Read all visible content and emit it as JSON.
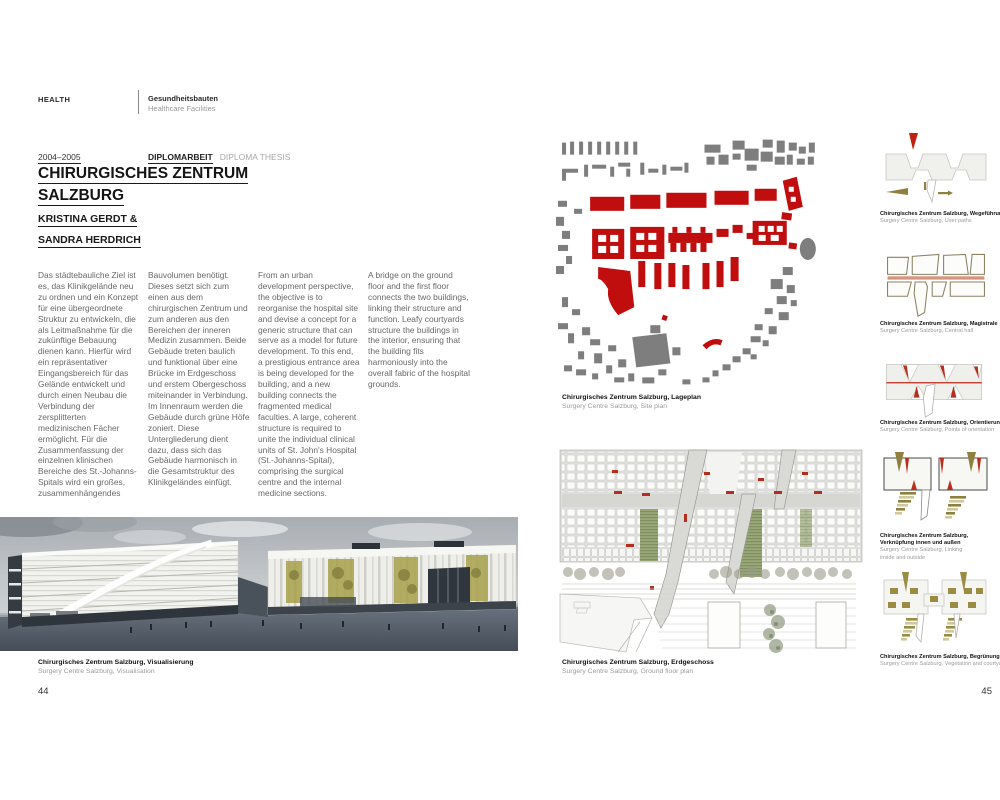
{
  "book": {
    "left_page": {
      "header": {
        "section_label": "HEALTH",
        "category_de": "Gesundheitsbauten",
        "category_en": "Healthcare Facilities"
      },
      "meta": {
        "years": "2004–2005",
        "type_de": "DIPLOMARBEIT",
        "type_en": "DIPLOMA THESIS"
      },
      "title": {
        "line1": "CHIRURGISCHES ZENTRUM",
        "line2": "SALZBURG"
      },
      "authors": {
        "line1": "KRISTINA GERDT &",
        "line2": "SANDRA HERDRICH"
      },
      "body_columns": [
        {
          "lang": "de",
          "text": "Das städtebauliche Ziel ist es, das Klinikgelände neu zu ordnen und ein Konzept für eine übergeordnete Struktur zu entwickeln, die als Leitmaßnahme für die zukünftige Bebauung dienen kann. Hierfür wird ein repräsentativer Eingangsbereich für das Gelände entwickelt und durch einen Neubau die Verbindung der zersplitterten medizinischen Fächer ermöglicht. Für die Zusammenfassung der einzelnen klinischen Bereiche des St.-Johanns-Spitals wird ein großes, zusammenhängendes"
        },
        {
          "lang": "de",
          "text": "Bauvolumen benötigt. Dieses setzt sich zum einen aus dem chirurgischen Zentrum und zum anderen aus den Bereichen der inneren Medizin zusammen. Beide Gebäude treten baulich und funktional über eine Brücke im Erdgeschoss und erstem Obergeschoss miteinander in Verbindung. Im Innenraum werden die Gebäude durch grüne Höfe zoniert. Diese Untergliederung dient dazu, dass sich das Gebäude harmonisch in die Gesamtstruktur des Klinikgeländes einfügt."
        },
        {
          "lang": "en",
          "text": "From an urban development perspective, the objective is to reorganise the hospital site and devise a concept for a generic structure that can serve as a model for future development. To this end, a prestigious entrance area is being developed for the building, and a new building connects the fragmented medical faculties. A large, coherent structure is required to unite the individual clinical units of St. John's Hospital (St.-Johanns-Spital), comprising the surgical centre and the internal medicine sections."
        },
        {
          "lang": "en",
          "text": "A bridge on the ground floor and the first floor connects the two buildings, linking their structure and function. Leafy courtyards structure the buildings in the interior, ensuring that the building fits harmoniously into the overall fabric of the hospital grounds."
        }
      ],
      "visual_caption": {
        "de": "Chirurgisches Zentrum Salzburg, Visualisierung",
        "en": "Surgery Centre Salzburg, Visualisation"
      },
      "page_number": "44"
    },
    "right_page": {
      "site_plan_caption": {
        "de": "Chirurgisches Zentrum Salzburg, Lageplan",
        "en": "Surgery Centre Salzburg, Site plan"
      },
      "floor_plan_caption": {
        "de": "Chirurgisches Zentrum Salzburg, Erdgeschoss",
        "en": "Surgery Centre Salzburg, Ground floor plan"
      },
      "diagrams": [
        {
          "caption_de": "Chirurgisches Zentrum Salzburg, Wegeführung",
          "caption_en": "Surgery Centre Salzburg, User paths"
        },
        {
          "caption_de": "Chirurgisches Zentrum Salzburg, Magistrale",
          "caption_en": "Surgery Centre Salzburg, Central hall"
        },
        {
          "caption_de": "Chirurgisches Zentrum Salzburg, Orientierungspunkte",
          "caption_en": "Surgery Centre Salzburg, Points of orientation"
        },
        {
          "caption_de": "Chirurgisches Zentrum Salzburg, Verknüpfung innen und außen",
          "caption_en": "Surgery Centre Salzburg, Linking inside and outside"
        },
        {
          "caption_de": "Chirurgisches Zentrum Salzburg, Begrünung und Höfe",
          "caption_en": "Surgery Centre Salzburg, Vegetation and courtyards"
        }
      ],
      "page_number": "45"
    },
    "colors": {
      "accent_red": "#c00d0d",
      "building_gray": "#7e7e7e",
      "olive": "#8f8040",
      "salmon_band": "#d49480",
      "caption_gray": "#9b9b9b"
    }
  }
}
